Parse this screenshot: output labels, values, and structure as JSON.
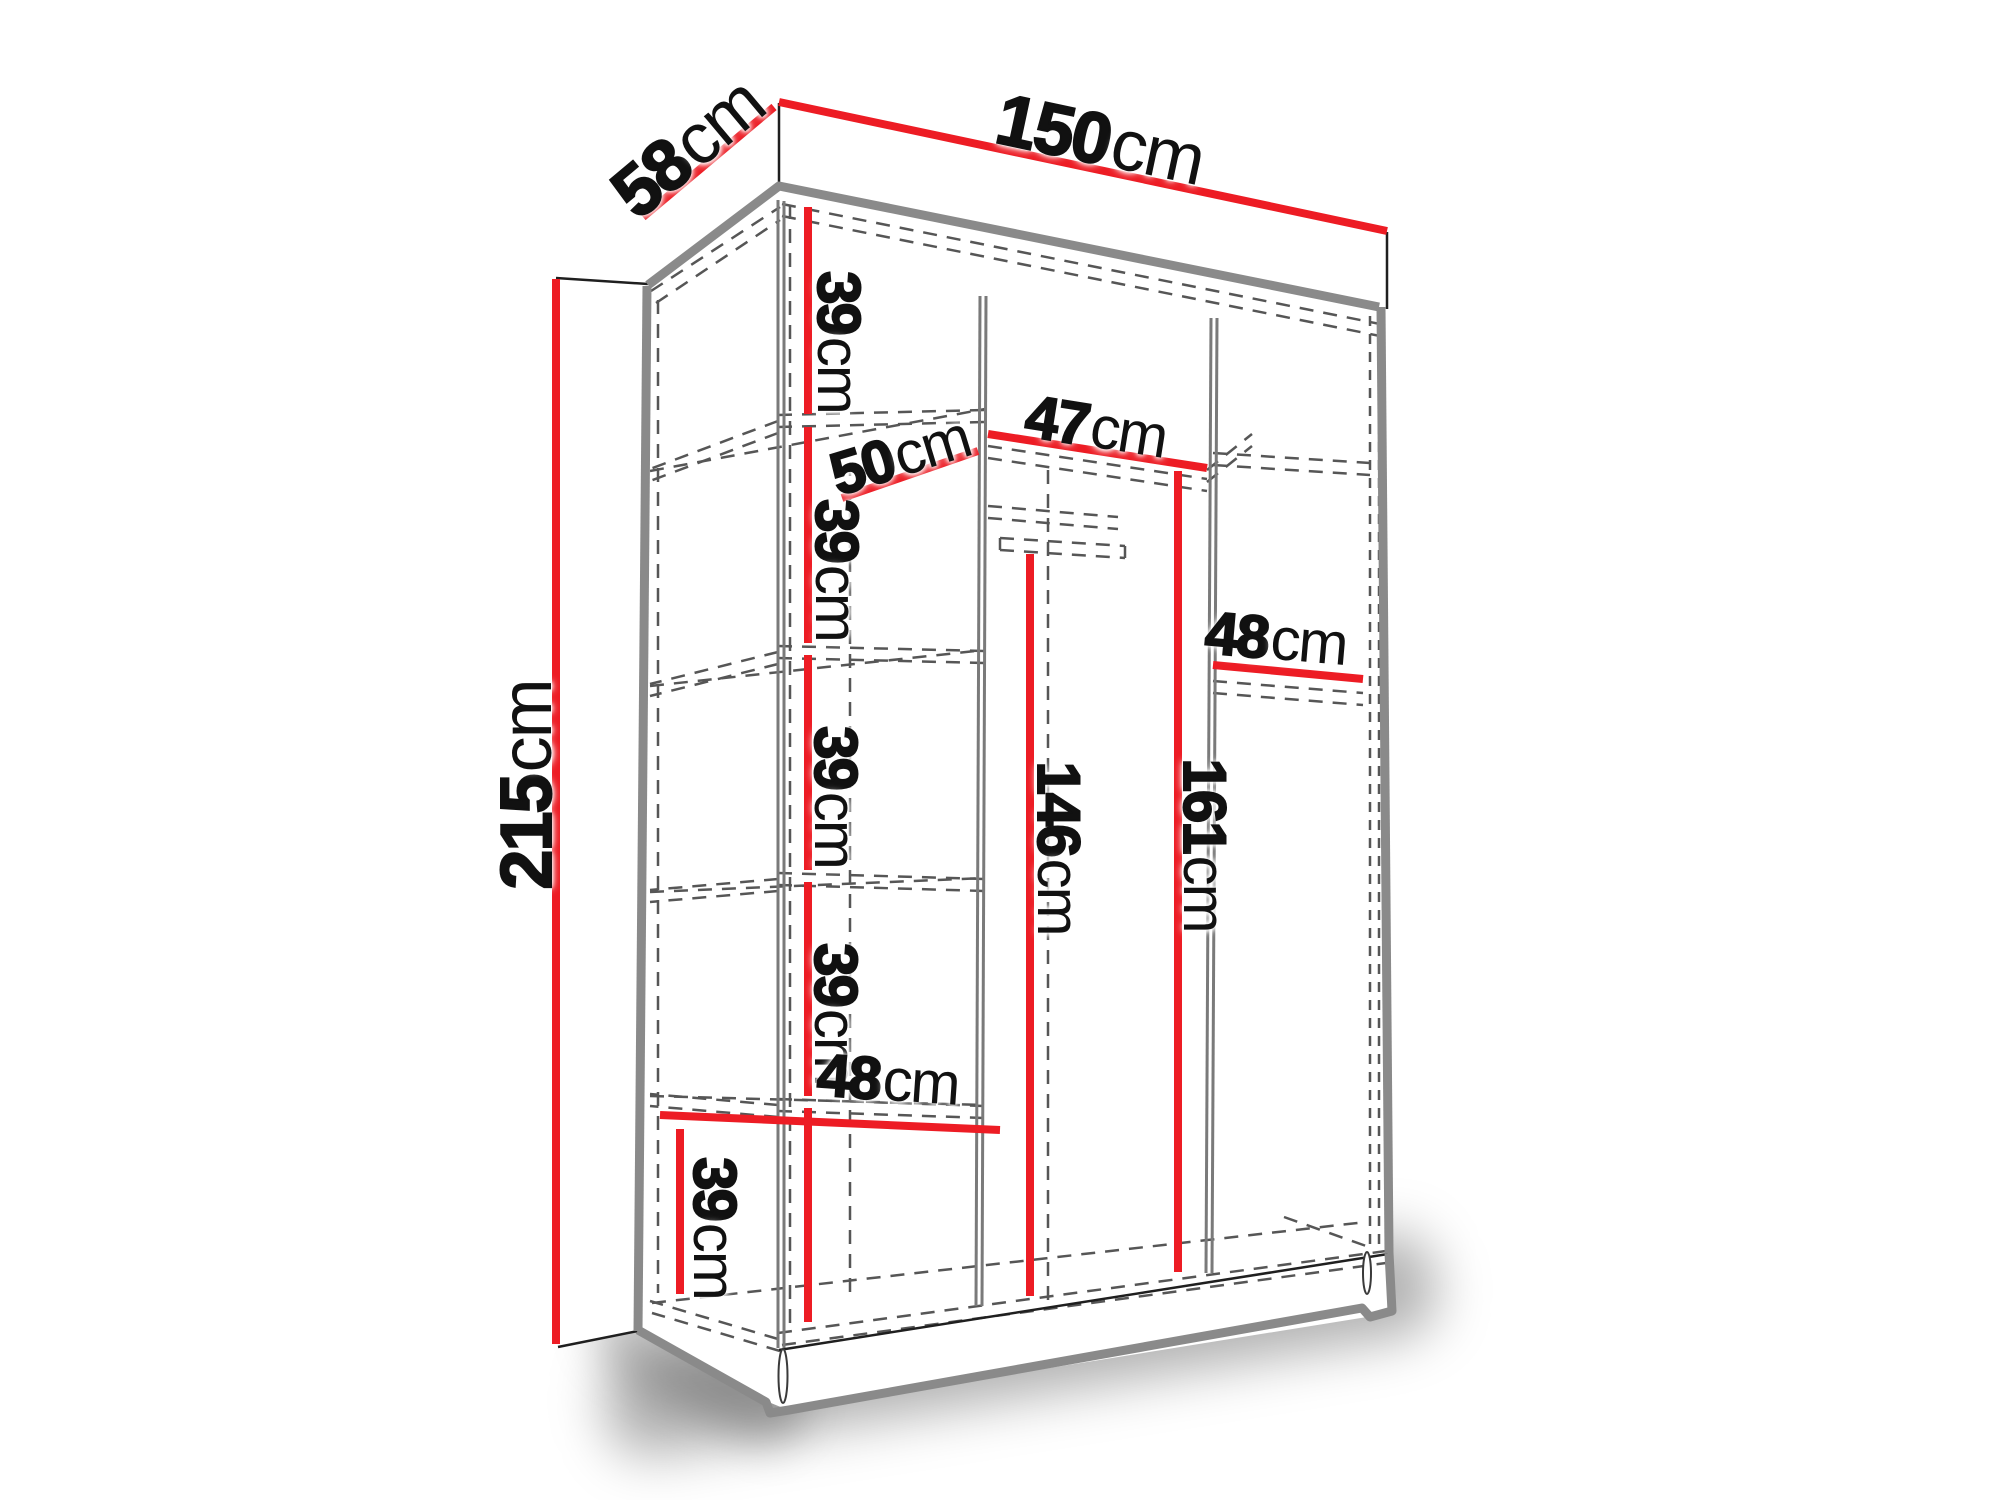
{
  "diagram": {
    "kind": "wardrobe-dimension-diagram",
    "units": "cm",
    "overall": {
      "width": {
        "num": "150",
        "unit": "cm"
      },
      "depth": {
        "num": "58",
        "unit": "cm"
      },
      "height": {
        "num": "215",
        "unit": "cm"
      }
    },
    "labels": {
      "d58": {
        "num": "58",
        "unit": "cm"
      },
      "w150": {
        "num": "150",
        "unit": "cm"
      },
      "h215": {
        "num": "215",
        "unit": "cm"
      },
      "s39a": {
        "num": "39",
        "unit": "cm"
      },
      "s39b": {
        "num": "39",
        "unit": "cm"
      },
      "s39c": {
        "num": "39",
        "unit": "cm"
      },
      "s39d": {
        "num": "39",
        "unit": "cm"
      },
      "s39e": {
        "num": "39",
        "unit": "cm"
      },
      "d50": {
        "num": "50",
        "unit": "cm"
      },
      "w47": {
        "num": "47",
        "unit": "cm"
      },
      "h146": {
        "num": "146",
        "unit": "cm"
      },
      "h161": {
        "num": "161",
        "unit": "cm"
      },
      "w48l": {
        "num": "48",
        "unit": "cm"
      },
      "w48r": {
        "num": "48",
        "unit": "cm"
      }
    },
    "colors": {
      "dimension_red": "#ed1c24",
      "outline_gray": "#8a8a8a",
      "line_black": "#1f1f1f",
      "dashed_gray": "#565656",
      "text": "#111111",
      "background": "#ffffff"
    }
  }
}
